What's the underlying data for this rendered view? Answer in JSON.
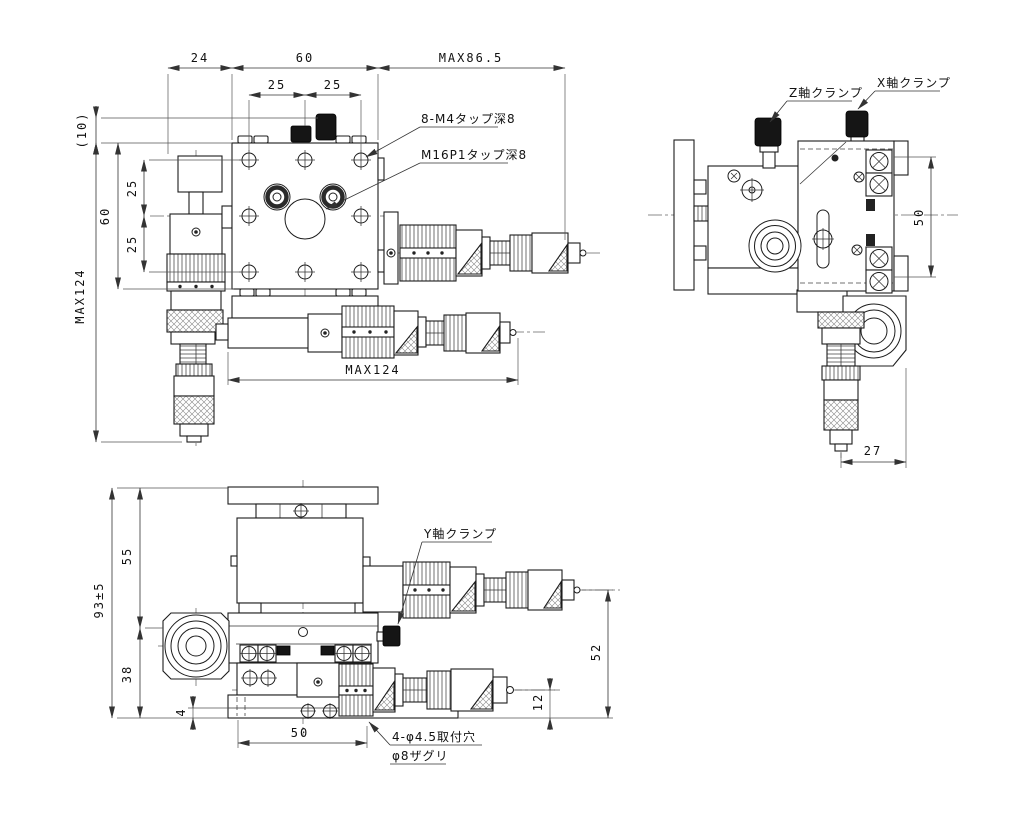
{
  "drawing": {
    "type": "mechanical-drawing",
    "views": {
      "plan": {
        "dims": {
          "top_24": "24",
          "top_60": "60",
          "top_max86_5": "MAX86.5",
          "top_25_left": "25",
          "top_25_right": "25",
          "left_10": "(10)",
          "left_max124": "MAX124",
          "left_60": "60",
          "left_25_upper": "25",
          "left_25_lower": "25",
          "bottom_max124": "MAX124"
        },
        "labels": {
          "tap_m4": "8-M4タップ深8",
          "tap_m16": "M16P1タップ深8"
        }
      },
      "side": {
        "dims": {
          "right_50": "50",
          "bottom_27": "27"
        },
        "labels": {
          "z_clamp": "Z軸クランプ",
          "x_clamp": "X軸クランプ"
        }
      },
      "front": {
        "dims": {
          "left_93": "93±5",
          "left_55": "55",
          "left_38": "38",
          "left_4": "4",
          "bottom_50": "50",
          "right_52": "52",
          "right_12": "12"
        },
        "labels": {
          "y_clamp": "Y軸クランプ",
          "mounting_holes": "4-φ4.5取付穴",
          "counterbore": "φ8ザグリ"
        }
      }
    },
    "colors": {
      "line": "#1c1c1c",
      "dim_line": "#333333",
      "knob_fill": "#151515",
      "background": "#ffffff"
    }
  }
}
